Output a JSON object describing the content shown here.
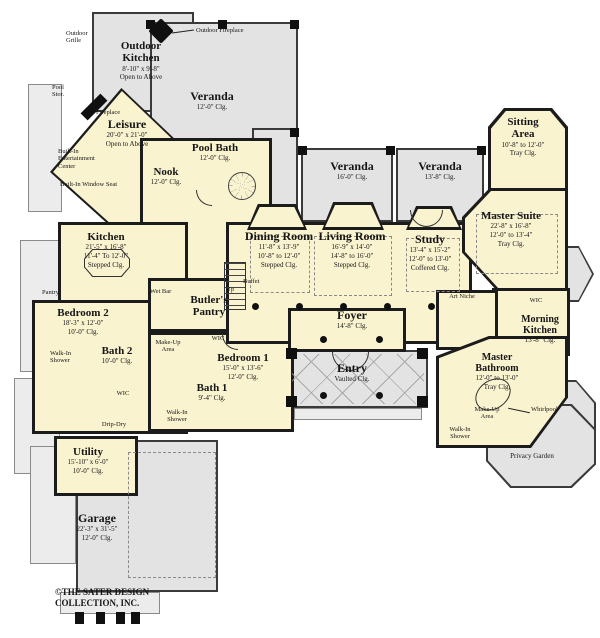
{
  "colors": {
    "interior": "#faf3cf",
    "outdoor": "#e3e3e3",
    "wall": "#1c1c1c"
  },
  "rooms": {
    "outdoor_kitchen": {
      "name": "Outdoor Kitchen",
      "l1": "8'-10\" x 9'-8\"",
      "l2": "Open to Above"
    },
    "veranda_top": {
      "name": "Veranda",
      "l1": "12'-0\" Clg."
    },
    "leisure": {
      "name": "Leisure",
      "l1": "20'-0\" x 21'-0\"",
      "l2": "Open to Above"
    },
    "pool_bath": {
      "name": "Pool Bath",
      "l1": "12'-0\" Clg."
    },
    "nook": {
      "name": "Nook",
      "l1": "12'-0\" Clg."
    },
    "kitchen": {
      "name": "Kitchen",
      "l1": "21'-5\" x 16'-8\"",
      "l2": "11'-4\" To 12'-0\"",
      "l3": "Stepped Clg."
    },
    "bedroom2": {
      "name": "Bedroom 2",
      "l1": "18'-3\" x 12'-0\"",
      "l2": "10'-0\" Clg."
    },
    "bath2": {
      "name": "Bath 2",
      "l1": "10'-0\" Clg."
    },
    "butlers_pantry": {
      "name": "Butler's Pantry"
    },
    "bedroom1": {
      "name": "Bedroom 1",
      "l1": "15'-0\" x 13'-6\"",
      "l2": "12'-0\" Clg."
    },
    "bath1": {
      "name": "Bath 1",
      "l1": "9'-4\" Clg."
    },
    "dining_room": {
      "name": "Dining Room",
      "l1": "11'-8\" x 13'-9\"",
      "l2": "10'-8\" to 12'-0\"",
      "l3": "Stepped Clg."
    },
    "living_room": {
      "name": "Living Room",
      "l1": "16'-9\" x 14'-0\"",
      "l2": "14'-8\" to 16'-0\"",
      "l3": "Stepped Clg."
    },
    "study": {
      "name": "Study",
      "l1": "13'-4\" x 15'-2\"",
      "l2": "12'-0\" to 13'-0\"",
      "l3": "Coffered Clg."
    },
    "veranda_mid_left": {
      "name": "Veranda",
      "l1": "16'-0\" Clg."
    },
    "veranda_mid_right": {
      "name": "Veranda",
      "l1": "13'-8\" Clg."
    },
    "sitting_area": {
      "name": "Sitting Area",
      "l1": "10'-8\" to 12'-0\"",
      "l2": "Tray Clg."
    },
    "master_suite": {
      "name": "Master Suite",
      "l1": "22'-8\" x 16'-8\"",
      "l2": "12'-0\" to 13'-4\"",
      "l3": "Tray Clg."
    },
    "morning_kitchen": {
      "name": "Morning Kitchen",
      "l1": "13'-8\" Clg."
    },
    "master_bathroom": {
      "name": "Master Bathroom",
      "l1": "12'-0\" to 13'-0\"",
      "l2": "Tray Clg."
    },
    "foyer": {
      "name": "Foyer",
      "l1": "14'-8\" Clg."
    },
    "entry": {
      "name": "Entry",
      "l1": "Vaulted Clg."
    },
    "utility": {
      "name": "Utility",
      "l1": "15'-10\" x 6'-0\"",
      "l2": "10'-0\" Clg."
    },
    "garage": {
      "name": "Garage",
      "l1": "22'-3\" x 31'-5\"",
      "l2": "12'-0\" Clg."
    },
    "privacy_garden": {
      "name": "Privacy Garden"
    }
  },
  "annotations": {
    "outdoor_grille": "Outdoor Grille",
    "outdoor_fireplace": "Outdoor Fireplace",
    "pool_stor": "Pool Stor.",
    "fireplace": "Fireplace",
    "built_in_entertainment_center": "Built-In Entertainment Center",
    "built_in_window_seat": "Built-In Window Seat",
    "pantry": "Pantry",
    "wet_bar": "Wet Bar",
    "up": "Up",
    "buffet": "Buffet",
    "art_niche": "Art Niche",
    "wic": "WIC",
    "drip_dry": "Drip-Dry",
    "walk_in_shower": "Walk-In Shower",
    "make_up_area": "Make-Up Area",
    "whirlpool": "Whirlpool",
    "copyright": "©THE SATER DESIGN COLLECTION, INC."
  }
}
